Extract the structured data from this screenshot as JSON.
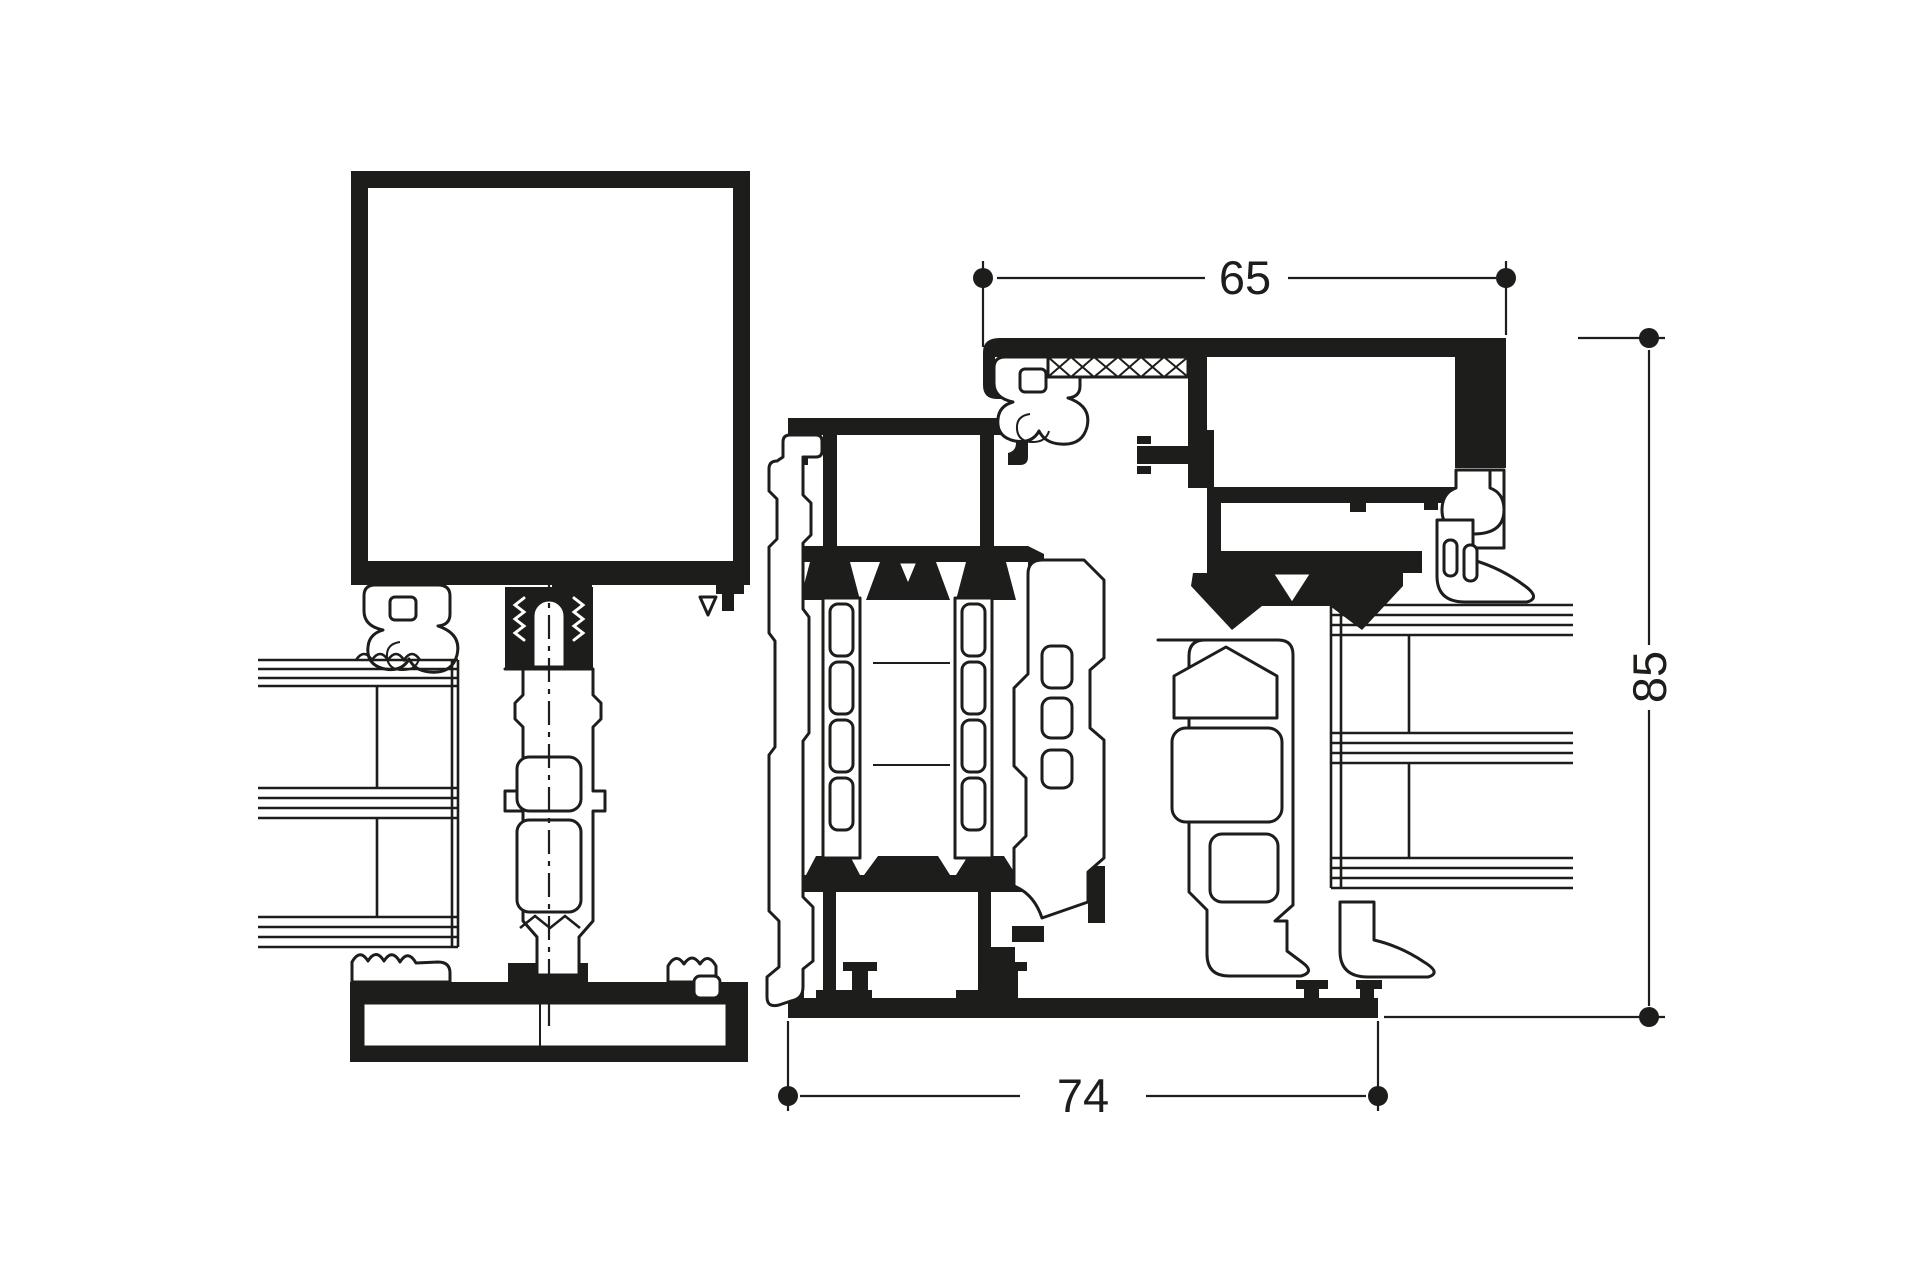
{
  "page": {
    "background": "#ffffff",
    "ink": "#1d1d1b",
    "description": "Technical cross-section detail drawing of aluminium window / door profiles with thermal breaks, gaskets and insulated glazing units"
  },
  "drawing": {
    "type": "technical-section",
    "units": "mm",
    "dimensions": [
      {
        "id": "top-width",
        "label": "65",
        "orientation": "horizontal",
        "position": "top"
      },
      {
        "id": "right-height",
        "label": "85",
        "orientation": "vertical",
        "position": "right"
      },
      {
        "id": "bottom-width",
        "label": "74",
        "orientation": "horizontal",
        "position": "bottom"
      }
    ],
    "components": [
      "sash-glass-panel",
      "glazing-unit-left",
      "glazing-unit-right",
      "screw-channel-mullion",
      "thermal-break-transom",
      "frame-head-profile",
      "frame-lower-profile",
      "hook-gasket-left",
      "hook-gasket-right",
      "tulip-gasket",
      "boot-gasket-top",
      "boot-gasket-bottom",
      "compressed-seal-crosshatch",
      "sill-profile-left",
      "sill-profile-right"
    ]
  }
}
